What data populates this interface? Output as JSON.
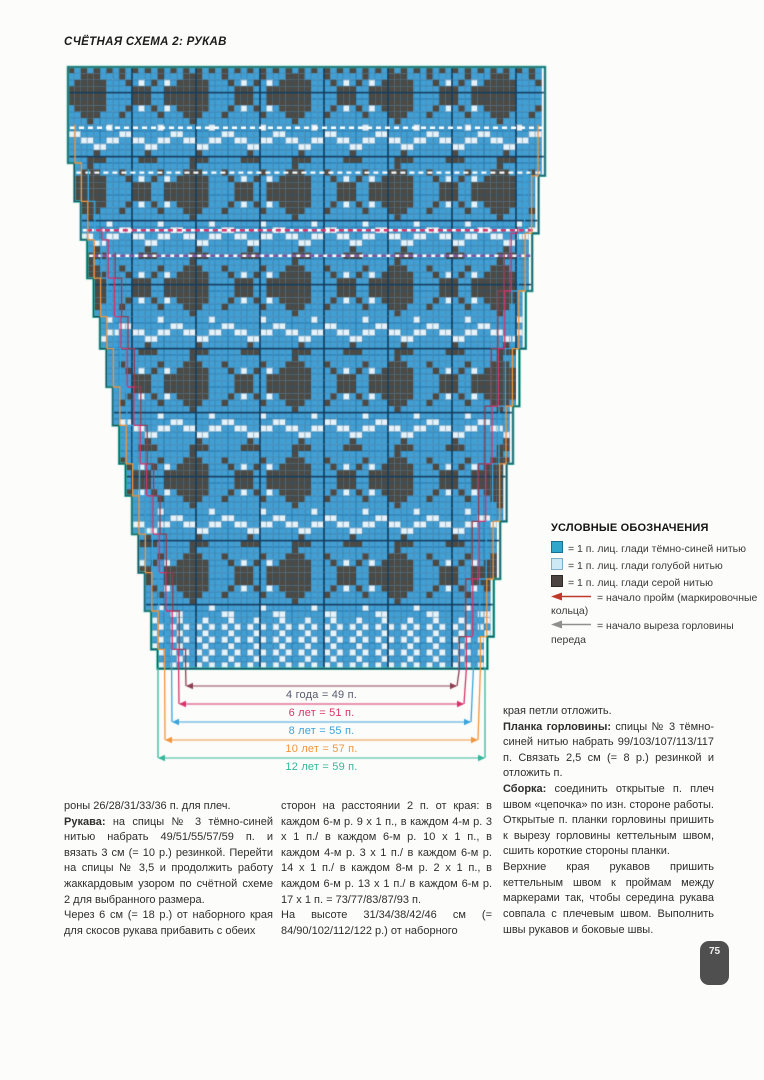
{
  "page": {
    "title": "СЧЁТНАЯ СХЕМА 2: РУКАВ",
    "page_number": "75"
  },
  "legend": {
    "title": "УСЛОВНЫЕ ОБОЗНАЧЕНИЯ",
    "items": [
      {
        "icon": "square",
        "color": "#2fa7cb",
        "border": "#15718f",
        "label": "= 1 п. лиц. глади тёмно-синей нитью"
      },
      {
        "icon": "square",
        "color": "#cde9f6",
        "border": "#7fb0c8",
        "label": "= 1 п. лиц. глади голубой нитью"
      },
      {
        "icon": "square",
        "color": "#4b4440",
        "border": "#2e2a27",
        "label": "= 1 п. лиц. глади серой нитью"
      },
      {
        "icon": "arrow",
        "color": "#c0392b",
        "label": "= начало пройм (маркировочные кольца)"
      },
      {
        "icon": "arrow",
        "color": "#8f8f8f",
        "label": "= начало выреза горловины переда"
      }
    ]
  },
  "chart": {
    "colors": {
      "bg": "#429fd4",
      "dark": "#4e4a43",
      "light": "#e6f3fb",
      "grid": "rgba(23,88,130,0.55)",
      "grid_bold": "#173f5e",
      "outline": "#1c4a68",
      "outer": "#35b79b"
    },
    "geometry": {
      "canvas_left": 38,
      "canvas_top": 56,
      "canvas_width": 548,
      "canvas_height": 735,
      "cell": 6.4,
      "top_y": 67,
      "bottom_y": 668,
      "left_top_x": 68,
      "left_bottom_x": 158,
      "right_top_x": 545,
      "right_bottom_x": 485,
      "straight_rows": 12,
      "left_inset_cells": 14,
      "right_inset_cells": 9
    },
    "dash_rows": [
      {
        "y": 123
      },
      {
        "y": 168
      },
      {
        "y": 225,
        "accent": "#d6336c"
      },
      {
        "y": 253,
        "accent": "#7e57a0"
      }
    ],
    "sizes": [
      {
        "label": "4 года = 49 п.",
        "line_color": "#8d4054",
        "label_color": "#565a6e",
        "arrow_y": 686,
        "inset": 4,
        "start_y": 253
      },
      {
        "label": "6 лет = 51 п.",
        "line_color": "#d6336c",
        "label_color": "#d6336c",
        "arrow_y": 704,
        "inset": 3,
        "start_y": 225
      },
      {
        "label": "8 лет = 55 п.",
        "line_color": "#3aa4dc",
        "label_color": "#3aa4dc",
        "arrow_y": 722,
        "inset": 2,
        "start_y": 168
      },
      {
        "label": "10 лет = 57 п.",
        "line_color": "#f09540",
        "label_color": "#f09540",
        "arrow_y": 740,
        "inset": 1,
        "start_y": 123
      },
      {
        "label": "12 лет = 59 п.",
        "line_color": "#35b79b",
        "label_color": "#35b79b",
        "arrow_y": 758,
        "inset": 0,
        "start_y": 67
      }
    ]
  },
  "columns": {
    "left": [
      {
        "text": "роны 26/28/31/33/36 п. для плеч."
      },
      {
        "lead": "Рукава:",
        "text": " на спицы № 3 тёмно-синей нитью набрать 49/51/55/57/59 п. и вязать 3 см (= 10 р.) резинкой. Перейти на спицы № 3,5 и продолжить работу жаккардовым узором по счётной схеме 2 для выбранного размера."
      },
      {
        "text": "Через 6 см (= 18 р.) от наборного края для скосов рукава прибавить с обеих"
      }
    ],
    "middle": [
      {
        "text": "сторон на расстоянии 2 п. от края: в каждом 6-м р. 9 х 1 п., в каждом 4-м р. 3 х 1 п./ в каждом 6-м р. 10 х 1 п., в каждом 4-м р. 3 х 1 п./ в каждом 6-м р. 14 х 1 п./ в каждом 8-м р. 2 х 1 п., в каждом 6-м р. 13 х 1 п./ в каждом 6-м р. 17 х 1 п. = 73/77/83/87/93 п."
      },
      {
        "text": "На высоте 31/34/38/42/46 см (= 84/90/102/112/122 р.) от наборного"
      }
    ],
    "right": [
      {
        "text": "края петли отложить."
      },
      {
        "lead": "Планка горловины:",
        "text": " спицы № 3 тёмно-синей нитью набрать 99/103/107/113/117 п. Связать 2,5 см (= 8 р.) резинкой и отложить п."
      },
      {
        "lead": "Сборка:",
        "text": " соединить открытые п. плеч швом «цепочка» по изн. стороне работы. Открытые п. планки горловины пришить к вырезу горловины кеттельным швом, сшить короткие стороны планки."
      },
      {
        "text": "Верхние края рукавов пришить кеттельным швом к проймам между маркерами так, чтобы середина рукава совпала с плечевым швом. Выполнить швы рукавов и боковые швы."
      }
    ]
  }
}
